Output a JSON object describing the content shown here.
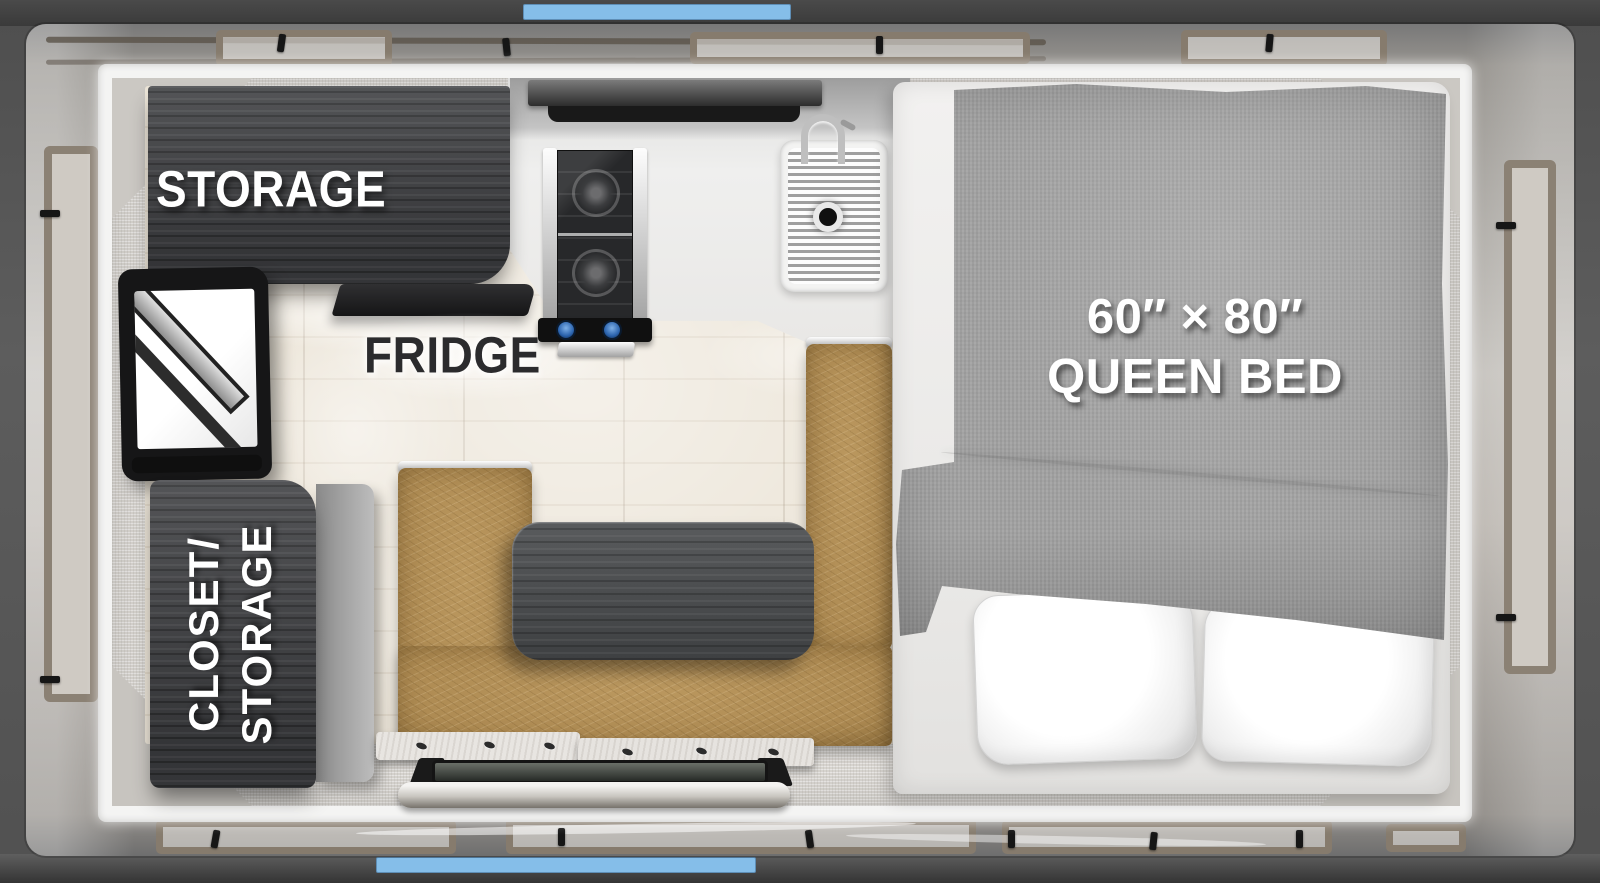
{
  "floorplan": {
    "labels": {
      "storage": "STORAGE",
      "fridge": "FRIDGE",
      "closet_line1": "CLOSET/",
      "closet_line2": "STORAGE",
      "bed_size": "60″ × 80″",
      "bed_type": "QUEEN BED"
    },
    "colors": {
      "accent_blue": "#84bde8",
      "outer_frame_gray": "#545454",
      "exterior_wall_gray": "#b5b2ad",
      "window_frame_taupe": "#8b8174",
      "inner_wall_white": "#f4f4f3",
      "interior_wall_fabric": "#d9d6d1",
      "floor_wood": "#eae2d4",
      "cabinet_dark_wood": "#404144",
      "dinette_leather_tan": "#ae8b53",
      "table_top_dark": "#47494b",
      "bed_blanket_gray": "#a3a3a3",
      "pillow_white": "#f7f7f7",
      "stove_knob_blue": "#3f7fd0"
    }
  }
}
